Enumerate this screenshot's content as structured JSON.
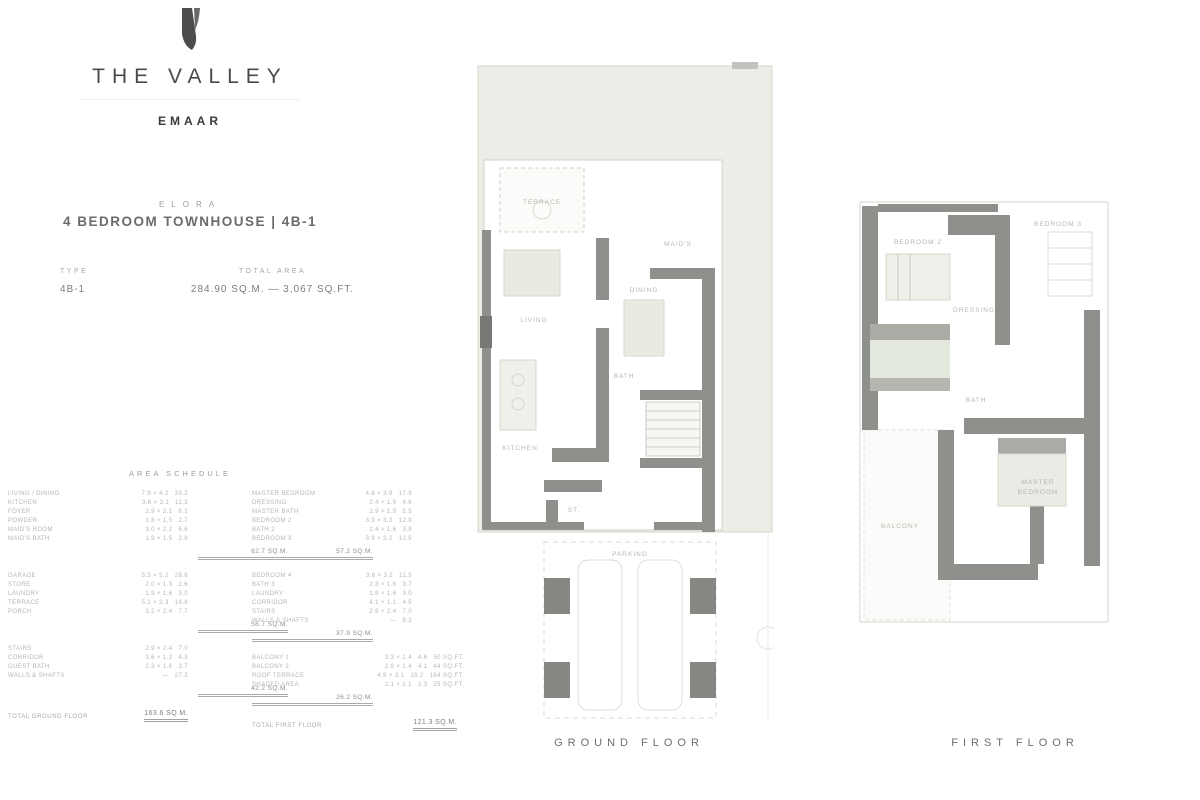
{
  "brand": {
    "logo_mark": "valley-leaf",
    "name": "THE VALLEY",
    "sub": "EMAAR"
  },
  "unit": {
    "eyebrow": "ELORA",
    "title": "4 BEDROOM TOWNHOUSE | 4B-1"
  },
  "specs": {
    "type_label": "TYPE",
    "type_value": "4B-1",
    "area_label": "TOTAL AREA",
    "area_value": "284.90 SQ.M.  —  3,067 SQ.FT."
  },
  "schedule": {
    "header": "AREA SCHEDULE",
    "columns": [
      {
        "groups": [
          {
            "rows": [
              [
                "LIVING / DINING",
                "7.9 × 4.2",
                "33.2"
              ],
              [
                "KITCHEN",
                "3.6 × 3.1",
                "11.2"
              ],
              [
                "FOYER",
                "2.9 × 2.1",
                "6.1"
              ],
              [
                "POWDER",
                "1.8 × 1.5",
                "2.7"
              ],
              [
                "MAID'S ROOM",
                "3.0 × 2.2",
                "6.6"
              ],
              [
                "MAID'S BATH",
                "1.9 × 1.5",
                "2.9"
              ]
            ],
            "total": "62.7 SQ.M."
          },
          {
            "rows": [
              [
                "GARAGE",
                "5.5 × 5.2",
                "28.6"
              ],
              [
                "STORE",
                "2.0 × 1.3",
                "2.6"
              ],
              [
                "LAUNDRY",
                "1.9 × 1.6",
                "3.0"
              ],
              [
                "TERRACE",
                "5.1 × 3.3",
                "16.8"
              ],
              [
                "PORCH",
                "3.2 × 2.4",
                "7.7"
              ]
            ],
            "total": "58.7 SQ.M."
          },
          {
            "rows": [
              [
                "STAIRS",
                "2.9 × 2.4",
                "7.0"
              ],
              [
                "CORRIDOR",
                "3.6 × 1.2",
                "4.3"
              ],
              [
                "GUEST BATH",
                "2.3 × 1.6",
                "3.7"
              ],
              [
                "WALLS & SHAFTS",
                "—",
                "27.2"
              ]
            ],
            "total": "42.2 SQ.M."
          }
        ],
        "total_label": "TOTAL GROUND FLOOR",
        "total_value": "163.6 SQ.M."
      },
      {
        "groups": [
          {
            "rows": [
              [
                "MASTER BEDROOM",
                "4.6 × 3.9",
                "17.9"
              ],
              [
                "DRESSING",
                "2.4 × 1.9",
                "4.6"
              ],
              [
                "MASTER BATH",
                "2.9 × 1.9",
                "5.5"
              ],
              [
                "BEDROOM 2",
                "3.9 × 3.3",
                "12.9"
              ],
              [
                "BATH 2",
                "2.4 × 1.6",
                "3.8"
              ],
              [
                "BEDROOM 3",
                "3.9 × 3.2",
                "12.5"
              ]
            ],
            "total": "57.2 SQ.M."
          },
          {
            "rows": [
              [
                "BEDROOM 4",
                "3.6 × 3.2",
                "11.5"
              ],
              [
                "BATH 3",
                "2.3 × 1.6",
                "3.7"
              ],
              [
                "LAUNDRY",
                "1.9 × 1.6",
                "3.0"
              ],
              [
                "CORRIDOR",
                "4.1 × 1.1",
                "4.5"
              ],
              [
                "STAIRS",
                "2.9 × 2.4",
                "7.0"
              ],
              [
                "WALLS & SHAFTS",
                "—",
                "8.2"
              ]
            ],
            "total": "37.9 SQ.M."
          },
          {
            "wide": true,
            "rows": [
              [
                "BALCONY 1",
                "3.3 × 1.4",
                "4.6",
                "50 SQ.FT."
              ],
              [
                "BALCONY 2",
                "2.9 × 1.4",
                "4.1",
                "44 SQ.FT."
              ],
              [
                "ROOF TERRACE",
                "4.9 × 3.1",
                "15.2",
                "164 SQ.FT."
              ],
              [
                "SHADED AREA",
                "2.1 × 1.1",
                "2.3",
                "25 SQ.FT."
              ]
            ],
            "total": "26.2 SQ.M."
          }
        ],
        "total_label": "TOTAL FIRST FLOOR",
        "total_value": "121.3 SQ.M."
      }
    ]
  },
  "plans": [
    {
      "caption": "GROUND FLOOR",
      "rooms": {
        "terrace": "TERRACE",
        "living": "LIVING",
        "dining": "DINING",
        "kitchen": "KITCHEN",
        "maid": "MAID'S",
        "bath": "BATH",
        "store": "ST.",
        "parking": "PARKING"
      }
    },
    {
      "caption": "FIRST FLOOR",
      "rooms": {
        "bedroom2": "BEDROOM 2",
        "bedroom3": "BEDROOM 3",
        "master": "MASTER",
        "master2": "BEDROOM",
        "bath": "BATH",
        "dressing": "DRESSING",
        "balcony": "BALCONY"
      }
    }
  ],
  "colors": {
    "plot_green": "#eaeee7",
    "wall_gray": "#8e908b",
    "furniture": "#e7ebe1",
    "faint_line": "#d3d8cd"
  }
}
